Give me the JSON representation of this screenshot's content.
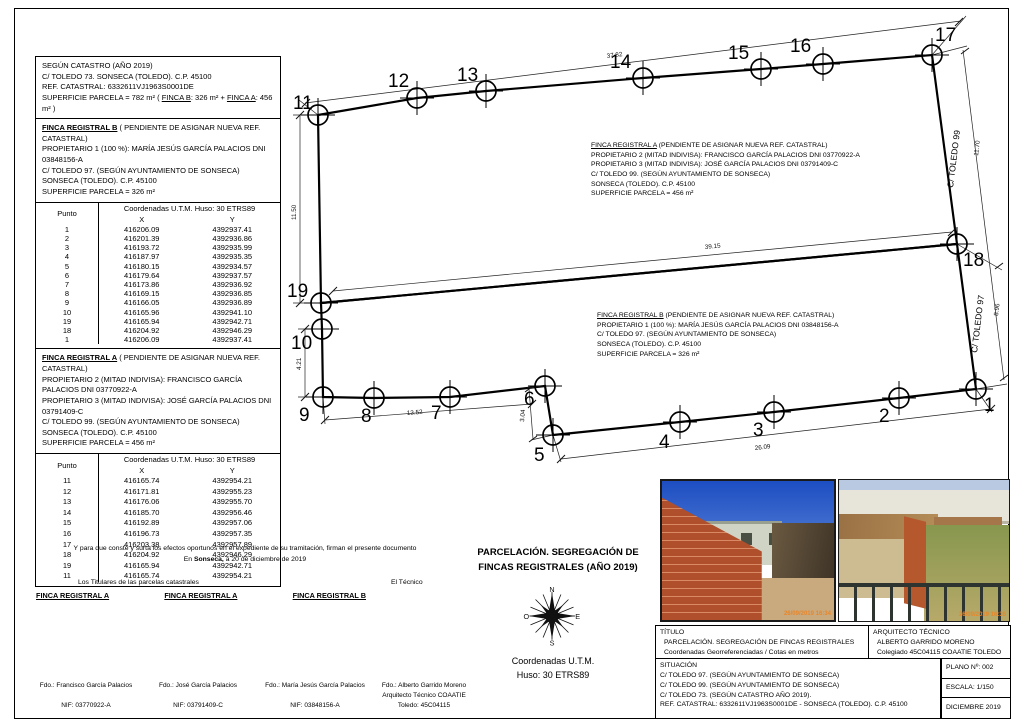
{
  "catastro_box": {
    "line1": "SEGÚN CATASTRO (AÑO 2019)",
    "line2": "C/ TOLEDO 73. SONSECA (TOLEDO). C.P. 45100",
    "line3": "REF.  CATASTRAL: 6332611VJ1963S0001DE",
    "sup_pre": "SUPERFICIE PARCELA = 782 m²  ( ",
    "sup_b": "FINCA B",
    "sup_mid": ": 326 m² + ",
    "sup_a": "FINCA A",
    "sup_post": ": 456 m² )"
  },
  "finca_b_box": {
    "title": "FINCA REGISTRAL B",
    "title_rest": "  ( PENDIENTE DE ASIGNAR NUEVA REF. CATASTRAL)",
    "lines": [
      "PROPIETARIO 1 (100 %): MARÍA JESÚS GARCÍA PALACIOS  DNI 03848156-A",
      "C/ TOLEDO 97. (SEGÚN AYUNTAMIENTO DE SONSECA)",
      "SONSECA (TOLEDO). C.P. 45100",
      "SUPERFICIE PARCELA = 326 m²"
    ]
  },
  "finca_a_box": {
    "title": "FINCA REGISTRAL A",
    "title_rest": "  ( PENDIENTE DE ASIGNAR NUEVA REF. CATASTRAL)",
    "lines": [
      "PROPIETARIO 2 (MITAD INDIVISA): FRANCISCO GARCÍA PALACIOS DNI 03770922-A",
      "PROPIETARIO 3 (MITAD INDIVISA): JOSÉ GARCÍA PALACIOS        DNI 03791409-C",
      "C/ TOLEDO 99. (SEGÚN AYUNTAMIENTO DE SONSECA)",
      "SONSECA (TOLEDO). C.P. 45100",
      "SUPERFICIE PARCELA = 456 m²"
    ]
  },
  "tables": {
    "punto_header": "Punto",
    "coord_header": "Coordenadas U.T.M. Huso: 30 ETRS89",
    "x_header": "X",
    "y_header": "Y",
    "b_rows": [
      [
        "1",
        "416206.09",
        "4392937.41"
      ],
      [
        "2",
        "416201.39",
        "4392936.86"
      ],
      [
        "3",
        "416193.72",
        "4392935.99"
      ],
      [
        "4",
        "416187.97",
        "4392935.35"
      ],
      [
        "5",
        "416180.15",
        "4392934.57"
      ],
      [
        "6",
        "416179.64",
        "4392937.57"
      ],
      [
        "7",
        "416173.86",
        "4392936.92"
      ],
      [
        "8",
        "416169.15",
        "4392936.85"
      ],
      [
        "9",
        "416166.05",
        "4392936.89"
      ],
      [
        "10",
        "416165.96",
        "4392941.10"
      ],
      [
        "19",
        "416165.94",
        "4392942.71"
      ],
      [
        "18",
        "416204.92",
        "4392946.29"
      ],
      [
        "1",
        "416206.09",
        "4392937.41"
      ]
    ],
    "a_rows": [
      [
        "11",
        "416165.74",
        "4392954.21"
      ],
      [
        "12",
        "416171.81",
        "4392955.23"
      ],
      [
        "13",
        "416176.06",
        "4392955.70"
      ],
      [
        "14",
        "416185.70",
        "4392956.46"
      ],
      [
        "15",
        "416192.89",
        "4392957.06"
      ],
      [
        "16",
        "416196.73",
        "4392957.35"
      ],
      [
        "17",
        "416203.38",
        "4392957.89"
      ],
      [
        "18",
        "416204.92",
        "4392946.29"
      ],
      [
        "19",
        "416165.94",
        "4392942.71"
      ],
      [
        "11",
        "416165.74",
        "4392954.21"
      ]
    ]
  },
  "drawing": {
    "points": {
      "p1": "1",
      "p2": "2",
      "p3": "3",
      "p4": "4",
      "p5": "5",
      "p6": "6",
      "p7": "7",
      "p8": "8",
      "p9": "9",
      "p10": "10",
      "p11": "11",
      "p12": "12",
      "p13": "13",
      "p14": "14",
      "p15": "15",
      "p16": "16",
      "p17": "17",
      "p18": "18",
      "p19": "19"
    },
    "dims": {
      "top": "37.82",
      "left": "11.50",
      "left2": "4.21",
      "mid": "39.15",
      "bottom1": "13.52",
      "step": "3.04",
      "bottom2": "26.09",
      "right_upper": "11.70",
      "right_lower": "8.96"
    },
    "street_upper": "C/ TOLEDO 99",
    "street_lower": "C/ TOLEDO 97",
    "note_a": {
      "title": "FINCA REGISTRAL A",
      "title_rest": " (PENDIENTE DE ASIGNAR NUEVA REF. CATASTRAL)",
      "lines": [
        "PROPIETARIO 2 (MITAD INDIVISA): FRANCISCO GARCÍA PALACIOS DNI 03770922-A",
        "PROPIETARIO 3 (MITAD INDIVISA): JOSÉ GARCÍA PALACIOS        DNI 03791409-C",
        "C/ TOLEDO 99. (SEGÚN AYUNTAMIENTO DE SONSECA)",
        "SONSECA (TOLEDO). C.P. 45100",
        "SUPERFICIE PARCELA = 456 m²"
      ]
    },
    "note_b": {
      "title": "FINCA REGISTRAL B",
      "title_rest": " (PENDIENTE DE ASIGNAR NUEVA REF. CATASTRAL)",
      "lines": [
        "PROPIETARIO 1 (100 %): MARÍA JESÚS GARCÍA PALACIOS  DNI 03848156-A",
        "C/ TOLEDO 97. (SEGÚN AYUNTAMIENTO DE SONSECA)",
        "SONSECA (TOLEDO). C.P. 45100",
        "SUPERFICIE PARCELA = 326 m²"
      ]
    }
  },
  "footer": {
    "par1": "Y para que conste y surta los efectos oportunos en el expediente de su tramitación, firman el presente documento",
    "par2_pre": "En ",
    "par2_bold": "Sonseca,",
    "par2_rest": " a 20 de diciembre de 2019",
    "titulares": "Los Titulares de las parcelas catastrales",
    "tecnico": "El Técnico",
    "finca_labels": [
      "FINCA REGISTRAL A",
      "FINCA REGISTRAL A",
      "FINCA REGISTRAL B"
    ],
    "sign1_fdo": "Fdo.: Francisco García Palacios",
    "sign1_nif": "NIF: 03770922-A",
    "sign2_fdo": "Fdo.: José García Palacios",
    "sign2_nif": "NIF: 03791409-C",
    "sign3_fdo": "Fdo.: María Jesús García Palacios",
    "sign3_nif": "NIF: 03848156-A",
    "sign4_fdo": "Fdo.: Alberto Garrido Moreno",
    "sign4_mid": "Arquitecto Técnico COAATIE",
    "sign4_nif": "Toledo: 45C04115"
  },
  "center": {
    "title_l1": "PARCELACIÓN. SEGREGACIÓN DE",
    "title_l2": "FINCAS REGISTRALES (AÑO 2019)",
    "coords_l1": "Coordenadas U.T.M.",
    "coords_l2": "Huso: 30 ETRS89",
    "compass": {
      "n": "N",
      "e": "E",
      "s": "S",
      "o": "O"
    }
  },
  "photos": {
    "stamp1": "26/09/2019 16:34",
    "stamp2": "26/09/2019 16:36"
  },
  "titleblock": {
    "titulo_label": "TÍTULO",
    "titulo_line1": "PARCELACIÓN. SEGREGACIÓN DE FINCAS REGISTRALES",
    "titulo_line2": "Coordenadas Georreferenciadas / Cotas en metros",
    "arq_label": "ARQUITECTO TÉCNICO",
    "arq_line1": "ALBERTO GARRIDO MORENO",
    "arq_line2": "Colegiado 45C04115 COAATIE TOLEDO",
    "sit_label": "SITUACIÓN",
    "sit_lines": [
      "C/ TOLEDO 97. (SEGÚN AYUNTAMIENTO DE SONSECA)",
      "C/ TOLEDO 99. (SEGÚN AYUNTAMIENTO DE SONSECA)",
      "C/ TOLEDO 73. (SEGÚN CATASTRO AÑO 2019).",
      "REF. CATASTRAL: 6332611VJ1963S0001DE  - SONSECA (TOLEDO). C.P. 45100"
    ],
    "plano": "PLANO Nº: 002",
    "escala": "ESCALA:  1/150",
    "fecha": "DICIEMBRE 2019"
  }
}
